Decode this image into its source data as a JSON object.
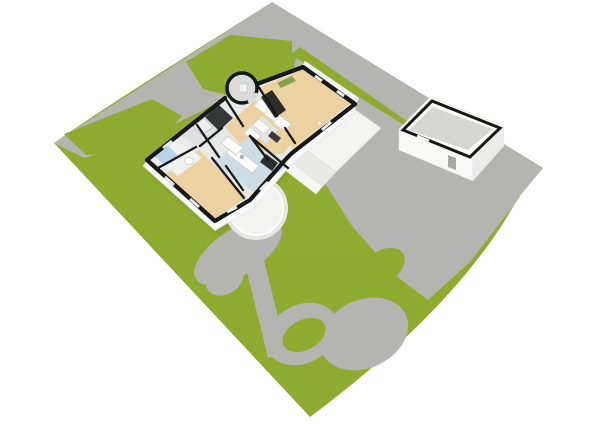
{
  "scene": {
    "title": "Aerial 3D floor plan site render",
    "view": "top-down oblique 3D render of a house lot",
    "colors": {
      "background": "#ffffff",
      "lawn": "#8fad2f",
      "paving": "#b6b7b3",
      "wall_outline": "#171717",
      "wall_face": "#fafaf8",
      "foundation": "#eeeeeb",
      "floor_wood": "#ecd2a0",
      "floor_kitchen": "#cddce5",
      "floor_bath": "#eff1ef",
      "floor_corridor": "#e8eae8",
      "floor_dark_room": "#35383a",
      "floor_turret": "#d9dcd9",
      "bathtub": "#b9d5ea",
      "terrace": "#f3f3f0",
      "terrace_step": "#e9e9e5",
      "wall_art_green": "#83a44e",
      "garage_floor": "#d6d7d4",
      "dark_appliance": "#2d2d2d",
      "fixture_white": "#fcfcfa"
    },
    "site": {
      "lot_shape": "diamond",
      "areas": [
        {
          "name": "lawn",
          "fill": "lawn"
        },
        {
          "name": "street-and-driveway",
          "fill": "paving"
        },
        {
          "name": "garden-path-loop",
          "fill": "paving"
        },
        {
          "name": "patio",
          "fill": "paving"
        },
        {
          "name": "lawn-islands",
          "count": 2,
          "fill": "lawn"
        }
      ]
    },
    "buildings": [
      {
        "id": "main-house",
        "label": "Main house (roof removed)",
        "rooms": [
          {
            "id": "living-room",
            "floor": "wood"
          },
          {
            "id": "hallway",
            "floor": "wood"
          },
          {
            "id": "dining-area",
            "floor": "wood"
          },
          {
            "id": "kitchen",
            "floor": "tile-blue",
            "fixtures": [
              "counter",
              "sink",
              "stove"
            ]
          },
          {
            "id": "utility-room",
            "floor": "tile",
            "fixtures": [
              "appliances"
            ]
          },
          {
            "id": "bathroom",
            "floor": "tile-white",
            "fixtures": [
              "bathtub",
              "toilet"
            ]
          },
          {
            "id": "shower-room",
            "floor": "tile-grey",
            "fixtures": [
              "shower-tray"
            ]
          },
          {
            "id": "storage-room",
            "floor": "dark"
          },
          {
            "id": "bedroom",
            "floor": "wood"
          },
          {
            "id": "entry-turret",
            "shape": "round",
            "floor": "tile-grey"
          }
        ],
        "features": [
          "round-porch",
          "terrace-with-steps",
          "wardrobes",
          "wall-art"
        ]
      },
      {
        "id": "garage",
        "label": "Detached garage / outbuilding",
        "rooms": [
          {
            "id": "garage-interior",
            "floor": "concrete"
          }
        ],
        "features": [
          "window-opening",
          "door-opening"
        ]
      }
    ]
  }
}
